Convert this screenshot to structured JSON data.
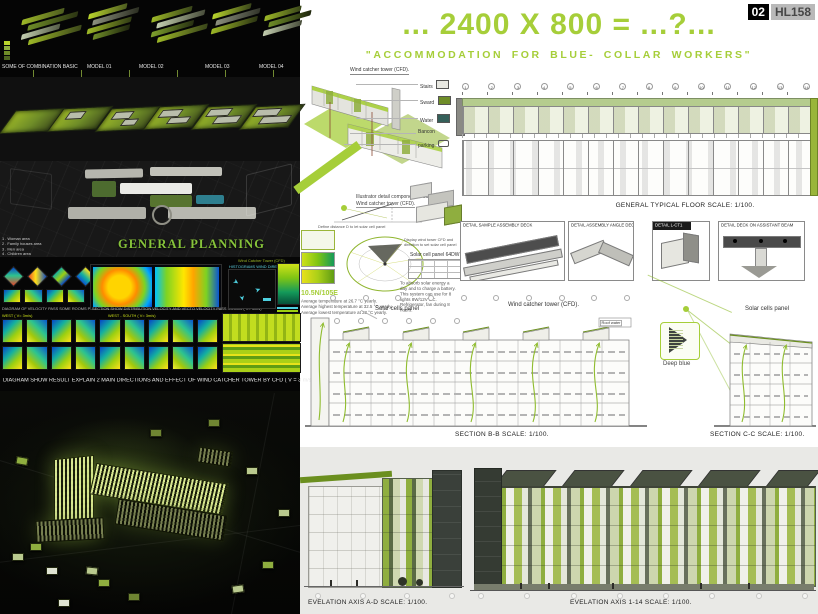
{
  "accent": "#a6ce39",
  "badge": {
    "number": "02",
    "code": "HL158"
  },
  "header": {
    "title": "... 2400 X 800 = ...?...",
    "subtitle": "\"ACCOMMODATION FOR BLUE- COLLAR WORKERS\""
  },
  "left": {
    "combination": {
      "caption": "SOME OF COMBINATION BASIC",
      "models": [
        "MODEL 01",
        "MODEL 02",
        "MODEL 03",
        "MODEL 04"
      ]
    },
    "planning": {
      "title": "GENERAL PLANNING",
      "areas": [
        "1 . Woman area",
        "2 . Family houses area",
        "3 . Men area",
        "4 . Children area",
        "5 . Specialists area"
      ],
      "wind_label": "Wind Catcher Tower (CFD)"
    },
    "cfd": {
      "caption_rooms": "DIAGRAM OF VELOCITY PASS SOME ROOMS PLAN",
      "caption_section": "SECTION SHOW DISTRIBUTION VELOCITY AND VECTO VELOCITY PASS ROOMS ( V= 3m/s)",
      "caption_histogram": "HISTOGRAMS WIND DIRECTION",
      "row_west": "WEST ( V= 3m/s)",
      "row_west_south": "WEST - SOUTH ( V= 3m/s)",
      "main_caption": "DIAGRAM SHOW RESULT EXPLAIN 2 MAIN DIRECTIONS AND EFFECT OF WIND CATCHER TOWER BY CFD ( V = 3 m/s)"
    }
  },
  "right": {
    "axon": {
      "title": "Wind catcher tower (CFD).",
      "callouts": [
        "Stairs",
        "Sward",
        "Water",
        "Bancon",
        "parking"
      ]
    },
    "solar": {
      "note1": "Illustrator detail component of building",
      "note2": "Wind catcher tower (CFD).",
      "define": "Define distance D to let  solar cell panel",
      "display": "Display wind tower CFD and direction to set solar cell panel",
      "panel_title": "Solar cell panel 64DW",
      "location": "10.5N/105E",
      "temps": [
        "Average temperature at 26.7 °C yearly.",
        "Average highest temperature at 32.5 °C yearly.",
        "Average lowest temperature at 23 °C yearly."
      ],
      "battery_note": "To absorb solar energy a day and to charge a battery. This system can use for 8 lights 8W/12V DC. Refrigerator, fan during 8 hours."
    },
    "floorplan": {
      "caption": "GENERAL TYPICAL FLOOR   SCALE: 1/100.",
      "grid": [
        "1",
        "2",
        "3",
        "4",
        "5",
        "6",
        "7",
        "8",
        "9",
        "10",
        "11",
        "12",
        "13",
        "14"
      ]
    },
    "details": [
      {
        "title": "DETAIL SAMPLE ASSEMBLY DECK"
      },
      {
        "title": "DETAIL ASSEMBLY ANGLE DECK"
      },
      {
        "title": "DETAIL L-CT1"
      },
      {
        "title": "DETAIL DECK ON ASSISTANT BEAM"
      }
    ],
    "sections": {
      "bb_caption": "SECTION B-B SCALE: 1/100.",
      "cc_caption": "SECTION C-C SCALE: 1/100.",
      "label_solar_left": "Solar cells panel",
      "label_wind": "Wind catcher tower (CFD).",
      "label_roof_water": "Roof water",
      "label_deep_blue": "Deep blue",
      "label_solar_right": "Solar cells panel"
    },
    "elevations": {
      "ad_caption": "EVELATION AXIS A-D SCALE: 1/100.",
      "axis_caption": "EVELATION AXIS 1-14 SCALE: 1/100."
    }
  }
}
